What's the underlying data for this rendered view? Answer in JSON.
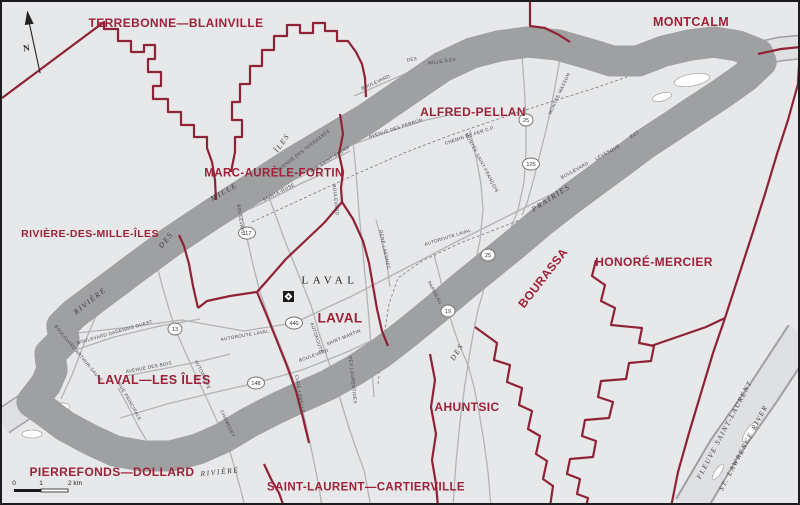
{
  "map": {
    "region_label": {
      "text": "LAVAL",
      "x": 328,
      "y": 279,
      "rot": 0
    },
    "city_symbol": "municipal-office-symbol",
    "north_label": "N",
    "scale": {
      "ticks": [
        "0",
        "1",
        "2 km"
      ]
    },
    "colors": {
      "boundary": "#8f2236",
      "riding_label": "#9e2139",
      "water": "#dfe0e2",
      "mainland": "#e7e8e9",
      "island": "#ffffff",
      "road": "#b2b3b5",
      "shoreline": "#9fa0a2"
    },
    "ridings": [
      {
        "name": "TERREBONNE—BLAINVILLE",
        "x": 174,
        "y": 21,
        "rot": 0,
        "size": 12
      },
      {
        "name": "MONTCALM",
        "x": 689,
        "y": 20,
        "rot": 0,
        "size": 12.5
      },
      {
        "name": "ALFRED-PELLAN",
        "x": 471,
        "y": 110,
        "rot": 0,
        "size": 12
      },
      {
        "name": "MARC-AURÈLE-FORTIN",
        "x": 272,
        "y": 172,
        "rot": 0,
        "size": 11.5
      },
      {
        "name": "RIVIÈRE-DES-MILLE-ÎLES",
        "x": 88,
        "y": 232,
        "rot": 0,
        "size": 10.5
      },
      {
        "name": "LAVAL",
        "x": 338,
        "y": 316,
        "rot": 0,
        "size": 13.5
      },
      {
        "name": "LAVAL—LES ÎLES",
        "x": 152,
        "y": 378,
        "rot": 0,
        "size": 12.5
      },
      {
        "name": "HONORÉ-MERCIER",
        "x": 652,
        "y": 260,
        "rot": 0,
        "size": 12
      },
      {
        "name": "BOURASSA",
        "x": 541,
        "y": 276,
        "rot": -52,
        "size": 12
      },
      {
        "name": "AHUNTSIC",
        "x": 465,
        "y": 405,
        "rot": 0,
        "size": 12
      },
      {
        "name": "PIERREFONDS—DOLLARD",
        "x": 110,
        "y": 470,
        "rot": 0,
        "size": 12
      },
      {
        "name": "SAINT-LAURENT—CARTIERVILLE",
        "x": 364,
        "y": 486,
        "rot": 0,
        "size": 11.5
      }
    ],
    "waterways": [
      {
        "text": "RIVIÈRE",
        "x": 88,
        "y": 299,
        "rot": -38,
        "size": 7.5
      },
      {
        "text": "DES",
        "x": 164,
        "y": 238,
        "rot": -52,
        "size": 7.5
      },
      {
        "text": "MILLE",
        "x": 222,
        "y": 190,
        "rot": -30,
        "size": 7.5
      },
      {
        "text": "ÎLES",
        "x": 280,
        "y": 141,
        "rot": -55,
        "size": 7.5
      },
      {
        "text": "RIVIÈRE",
        "x": 218,
        "y": 470,
        "rot": -6,
        "size": 7.5
      },
      {
        "text": "DES",
        "x": 455,
        "y": 350,
        "rot": -58,
        "size": 7.5
      },
      {
        "text": "PRAIRIES",
        "x": 549,
        "y": 196,
        "rot": -33,
        "size": 7.5
      },
      {
        "text": "FLEUVE SAINT-LAURENT",
        "x": 723,
        "y": 428,
        "rot": -62,
        "size": 7
      },
      {
        "text": "ST. LAWRENCE RIVER",
        "x": 742,
        "y": 446,
        "rot": -62,
        "size": 7
      }
    ],
    "roads": [
      {
        "text": "AUTOROUTE  LAVAL",
        "x": 243,
        "y": 334,
        "rot": -10
      },
      {
        "text": "AUTOROUTE  LAVAL",
        "x": 446,
        "y": 236,
        "rot": -17
      },
      {
        "text": "BOULEVARD",
        "x": 374,
        "y": 81,
        "rot": -24
      },
      {
        "text": "DES",
        "x": 410,
        "y": 58,
        "rot": -10
      },
      {
        "text": "MILLE-ÎLES",
        "x": 440,
        "y": 60,
        "rot": -8
      },
      {
        "text": "AVENUE  DES  PERRON",
        "x": 394,
        "y": 127,
        "rot": -18
      },
      {
        "text": "CHEMIN DE FER C.P.",
        "x": 468,
        "y": 134,
        "rot": -18
      },
      {
        "text": "MONTÉE  MASSON",
        "x": 558,
        "y": 92,
        "rot": -65
      },
      {
        "text": "MONTÉE  SAINT-FRANÇOIS",
        "x": 479,
        "y": 161,
        "rot": 62
      },
      {
        "text": "BOULEVARD",
        "x": 573,
        "y": 169,
        "rot": -29
      },
      {
        "text": "LÉVESQUE",
        "x": 606,
        "y": 151,
        "rot": -30
      },
      {
        "text": "EST",
        "x": 633,
        "y": 133,
        "rot": -30
      },
      {
        "text": "SAINTE-ROSE",
        "x": 277,
        "y": 191,
        "rot": -27
      },
      {
        "text": "AVENUE DES TERRASSES",
        "x": 302,
        "y": 149,
        "rot": -38
      },
      {
        "text": "AVE SAINT-SAËNS",
        "x": 328,
        "y": 158,
        "rot": -33
      },
      {
        "text": "BOULEVARD",
        "x": 238,
        "y": 218,
        "rot": 82
      },
      {
        "text": "CURÉ-LABELLE",
        "x": 297,
        "y": 392,
        "rot": 80
      },
      {
        "text": "BOULEVARD",
        "x": 333,
        "y": 198,
        "rot": 84
      },
      {
        "text": "DES  LAURENTIDES",
        "x": 350,
        "y": 378,
        "rot": 84
      },
      {
        "text": "RENÉ-LAENNEC",
        "x": 382,
        "y": 248,
        "rot": 78
      },
      {
        "text": "AUTOROUTE",
        "x": 314,
        "y": 336,
        "rot": 72
      },
      {
        "text": "AUTOROUTE",
        "x": 200,
        "y": 373,
        "rot": 65
      },
      {
        "text": "CHOMEDEY",
        "x": 225,
        "y": 422,
        "rot": 65
      },
      {
        "text": "BOULEVARD  DAGENAIS  OUEST",
        "x": 113,
        "y": 331,
        "rot": -16
      },
      {
        "text": "BOULEVARD  ARTHUR-SAUVÉ",
        "x": 76,
        "y": 352,
        "rot": 50
      },
      {
        "text": "AVENUE  DES  BOIS",
        "x": 147,
        "y": 366,
        "rot": -11
      },
      {
        "text": "RUE  PRINCIPALE",
        "x": 127,
        "y": 400,
        "rot": 60
      },
      {
        "text": "BOULEVARD",
        "x": 312,
        "y": 354,
        "rot": -20
      },
      {
        "text": "SAINT-MARTIN",
        "x": 342,
        "y": 336,
        "rot": -22
      },
      {
        "text": "PAPINEAU",
        "x": 432,
        "y": 291,
        "rot": 62
      }
    ],
    "shields": [
      {
        "num": "117",
        "x": 245,
        "y": 231
      },
      {
        "num": "13",
        "x": 173,
        "y": 327
      },
      {
        "num": "440",
        "x": 292,
        "y": 321
      },
      {
        "num": "148",
        "x": 254,
        "y": 381
      },
      {
        "num": "19",
        "x": 446,
        "y": 309
      },
      {
        "num": "25",
        "x": 524,
        "y": 118
      },
      {
        "num": "125",
        "x": 529,
        "y": 162
      },
      {
        "num": "25",
        "x": 486,
        "y": 253
      }
    ]
  }
}
